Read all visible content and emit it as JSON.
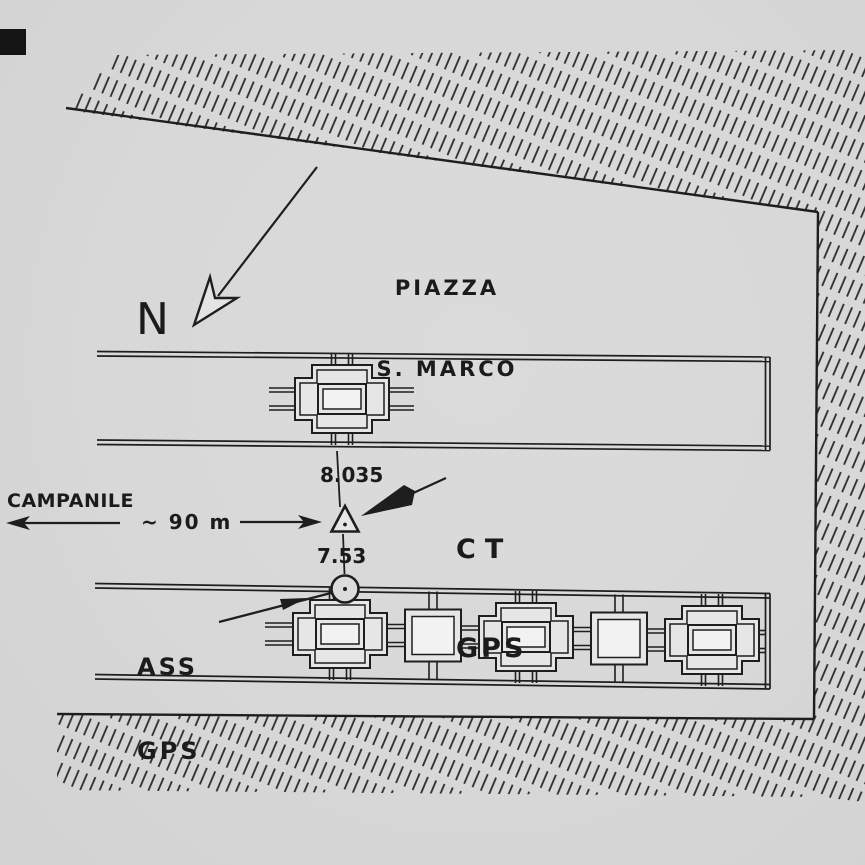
{
  "figure": {
    "description": "Hand-drawn survey sketch (plan view) of Piazza S. Marco with GPS station markers",
    "colors": {
      "paper": "#d8d8d8",
      "ink": "#1e1e1e",
      "hatch": "#2c2c2c"
    }
  },
  "labels": {
    "piazza_line1": "PIAZZA",
    "piazza_line2": "S. MARCO",
    "north": "N",
    "campanile": "CAMPANILE",
    "distance": "~ 90 m",
    "ct_line1": "CT",
    "ct_line2": "GPS",
    "ass_line1": "ASS",
    "ass_line2": "GPS",
    "elevation_ct": "8.035",
    "elevation_ass": "7.53"
  },
  "symbols": {
    "ct_marker": "triangle-with-center-dot",
    "ass_marker": "circle-with-center-dot",
    "north_arrow": "open-dart-arrow",
    "border": "diagonal-hatch-band"
  }
}
